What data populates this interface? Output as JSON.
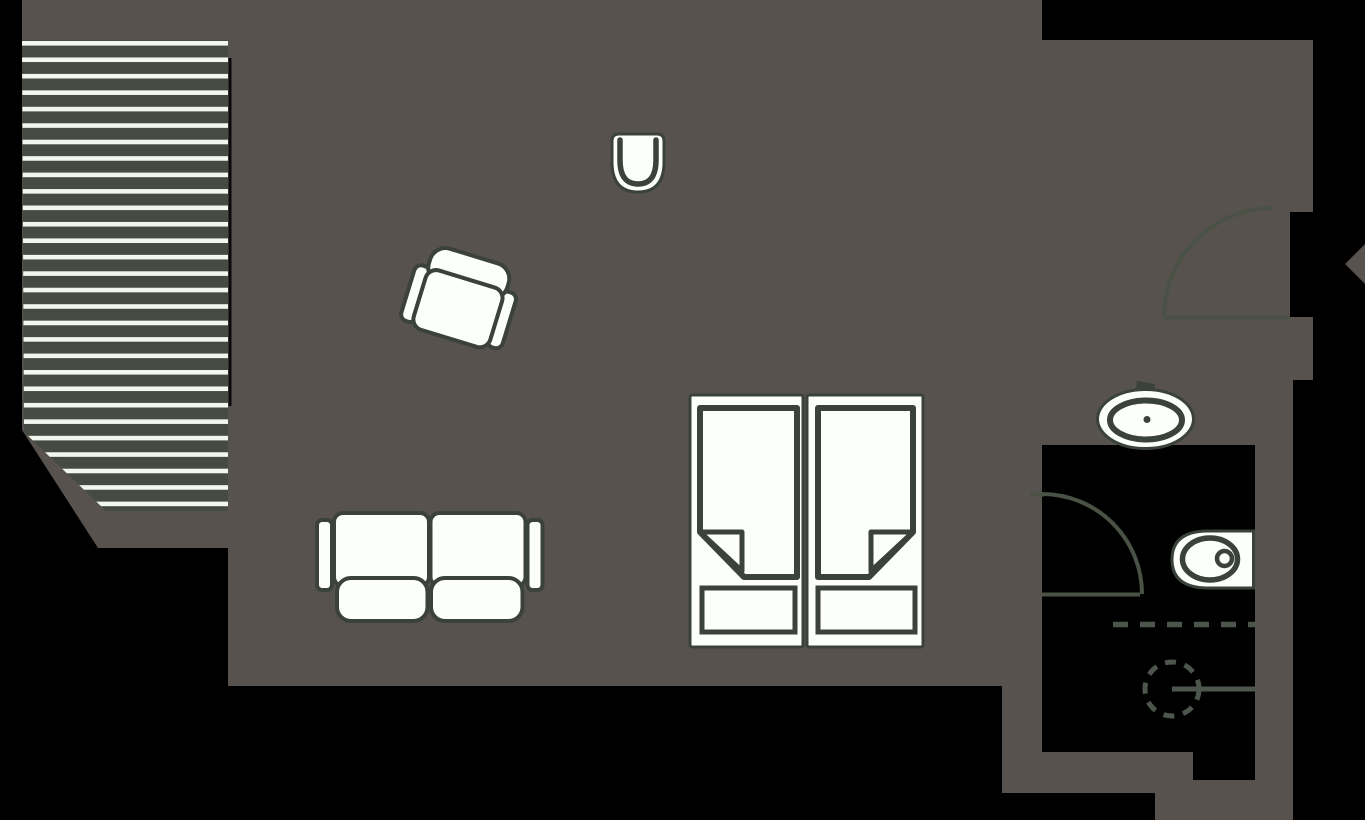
{
  "canvas": {
    "width": 1365,
    "height": 820
  },
  "palette": {
    "outside_black": "#000000",
    "floor_gray": "#57524e",
    "deck_green": "#454b41",
    "deck_stripe_white": "#f1f6ee",
    "furniture_white": "#fdfffc",
    "furniture_stroke": "#3a423b",
    "door_stroke": "#4a5245",
    "shower_stroke": "#4d564c",
    "wall_line_black": "#0a0a0a"
  },
  "layers": [
    {
      "name": "apartment-floor",
      "interactable": false,
      "shapes": [
        {
          "tag": "polygon",
          "attrs": {
            "points": "22,0 1042,0 1042,40 1313,40 1313,212 1290,212 1290,317 1313,317 1313,380 1293,380 1293,820 1155,820 1155,793 1002,793 1002,686 228,686 228,548 98,548 22,430",
            "fill": "@floor_gray"
          }
        }
      ]
    },
    {
      "name": "deck-terrace",
      "interactable": false,
      "shapes": [
        {
          "tag": "clipPath",
          "attrs": {
            "id": "deckClip"
          },
          "children": [
            {
              "tag": "polygon",
              "attrs": {
                "points": "22,40 228,40 228,511 106,511 24,432"
              }
            }
          ]
        },
        {
          "tag": "polygon",
          "attrs": {
            "points": "22,40 228,40 228,511 106,511 24,432",
            "fill": "@deck_green"
          }
        },
        {
          "tag": "g",
          "attrs": {
            "clip-path": "url(#deckClip)"
          },
          "children": [
            {
              "tag": "rect",
              "attrs": {
                "x": 22,
                "y": 41,
                "width": 206,
                "height": 4.6,
                "fill": "@deck_stripe_white"
              },
              "repeat": {
                "count": 29,
                "dy": 16.45
              }
            }
          ]
        }
      ]
    },
    {
      "name": "deck-wall-line",
      "interactable": false,
      "shapes": [
        {
          "tag": "rect",
          "attrs": {
            "x": 228.5,
            "y": 58,
            "width": 3,
            "height": 348,
            "fill": "@wall_line_black"
          }
        }
      ]
    },
    {
      "name": "bathroom-floor",
      "interactable": false,
      "shapes": [
        {
          "tag": "path",
          "attrs": {
            "d": "M 1042,445 H 1255 V 780 H 1193 V 752 H 1042 Z",
            "fill": "@outside_black"
          }
        }
      ]
    },
    {
      "name": "entry-door-swing",
      "interactable": false,
      "shapes": [
        {
          "tag": "line",
          "attrs": {
            "x1": 1164,
            "y1": 317.5,
            "x2": 1290,
            "y2": 317.5,
            "stroke": "@door_stroke",
            "stroke-width": 4
          }
        },
        {
          "tag": "path",
          "attrs": {
            "d": "M 1164,317 A 109 109 0 0 1 1273,208",
            "fill": "none",
            "stroke": "@door_stroke",
            "stroke-width": 4
          }
        }
      ]
    },
    {
      "name": "bathroom-door-swing",
      "interactable": false,
      "shapes": [
        {
          "tag": "line",
          "attrs": {
            "x1": 1030,
            "y1": 494.5,
            "x2": 1044,
            "y2": 494.5,
            "stroke": "@door_stroke",
            "stroke-width": 4
          }
        },
        {
          "tag": "path",
          "attrs": {
            "d": "M 1042,494 A 100 100 0 0 1 1142,594",
            "fill": "none",
            "stroke": "@door_stroke",
            "stroke-width": 4
          }
        },
        {
          "tag": "line",
          "attrs": {
            "x1": 1042,
            "y1": 594.5,
            "x2": 1140,
            "y2": 594.5,
            "stroke": "@door_stroke",
            "stroke-width": 4
          }
        }
      ]
    },
    {
      "name": "shower-area",
      "interactable": false,
      "shapes": [
        {
          "tag": "line",
          "attrs": {
            "x1": 1113,
            "y1": 624.5,
            "x2": 1255,
            "y2": 624.5,
            "stroke": "@shower_stroke",
            "stroke-width": 5.5,
            "stroke-dasharray": "15 12"
          }
        },
        {
          "tag": "circle",
          "attrs": {
            "cx": 1172,
            "cy": 689,
            "r": 27,
            "fill": "none",
            "stroke": "@shower_stroke",
            "stroke-width": 5,
            "stroke-dasharray": "11 9"
          }
        },
        {
          "tag": "line",
          "attrs": {
            "x1": 1172,
            "y1": 689,
            "x2": 1255,
            "y2": 689,
            "stroke": "@shower_stroke",
            "stroke-width": 5
          }
        }
      ]
    },
    {
      "name": "sink",
      "interactable": false,
      "shapes": [
        {
          "tag": "polygon",
          "attrs": {
            "points": "1137,381 1155,384 1154,391 1136,388",
            "fill": "@furniture_stroke"
          }
        },
        {
          "tag": "line",
          "attrs": {
            "x1": 1146.5,
            "y1": 386,
            "x2": 1146.5,
            "y2": 406,
            "stroke": "@furniture_stroke",
            "stroke-width": 5
          }
        },
        {
          "tag": "ellipse",
          "attrs": {
            "cx": 1145.5,
            "cy": 419,
            "rx": 48,
            "ry": 29.5,
            "fill": "@furniture_white",
            "stroke": "@furniture_stroke",
            "stroke-width": 3
          }
        },
        {
          "tag": "ellipse",
          "attrs": {
            "cx": 1146,
            "cy": 420,
            "rx": 36,
            "ry": 19.5,
            "fill": "none",
            "stroke": "@furniture_stroke",
            "stroke-width": 6
          }
        },
        {
          "tag": "circle",
          "attrs": {
            "cx": 1147,
            "cy": 419.5,
            "r": 3.5,
            "fill": "@furniture_stroke"
          }
        }
      ]
    },
    {
      "name": "toilet",
      "interactable": false,
      "shapes": [
        {
          "tag": "path",
          "attrs": {
            "d": "M 1253.5,531 L 1206,531 Q 1172,532 1172,559.5 Q 1172,587 1206,588 L 1253.5,588 Z",
            "fill": "@furniture_white",
            "stroke": "@furniture_stroke",
            "stroke-width": 3
          }
        },
        {
          "tag": "ellipse",
          "attrs": {
            "cx": 1210,
            "cy": 559,
            "rx": 27.5,
            "ry": 21,
            "fill": "none",
            "stroke": "@furniture_stroke",
            "stroke-width": 5.5
          }
        },
        {
          "tag": "circle",
          "attrs": {
            "cx": 1224.5,
            "cy": 558.5,
            "r": 7.5,
            "fill": "@furniture_white",
            "stroke": "@furniture_stroke",
            "stroke-width": 4.5
          }
        }
      ]
    },
    {
      "name": "double-bed",
      "interactable": false,
      "shapes": [
        {
          "tag": "rect",
          "attrs": {
            "x": 690,
            "y": 395,
            "width": 113,
            "height": 252,
            "rx": 2,
            "fill": "@furniture_white",
            "stroke": "@furniture_stroke",
            "stroke-width": 3
          }
        },
        {
          "tag": "rect",
          "attrs": {
            "x": 807,
            "y": 395,
            "width": 116,
            "height": 252,
            "rx": 2,
            "fill": "@furniture_white",
            "stroke": "@furniture_stroke",
            "stroke-width": 3
          }
        },
        {
          "tag": "path",
          "attrs": {
            "d": "M 700,408 L 797,408 L 797,577 L 744,577 L 700,532 Z",
            "fill": "@furniture_white",
            "stroke": "@furniture_stroke",
            "stroke-width": 6,
            "stroke-linejoin": "round"
          }
        },
        {
          "tag": "path",
          "attrs": {
            "d": "M 700,532 L 742,532 L 742,571 Z",
            "fill": "@furniture_white",
            "stroke": "@furniture_stroke",
            "stroke-width": 5,
            "stroke-linejoin": "round"
          }
        },
        {
          "tag": "rect",
          "attrs": {
            "x": 702,
            "y": 588,
            "width": 93,
            "height": 44,
            "fill": "@furniture_white",
            "stroke": "@furniture_stroke",
            "stroke-width": 5
          }
        },
        {
          "tag": "path",
          "attrs": {
            "d": "M 913,408 L 818,408 L 818,577 L 869,577 L 913,532 Z",
            "fill": "@furniture_white",
            "stroke": "@furniture_stroke",
            "stroke-width": 6,
            "stroke-linejoin": "round"
          }
        },
        {
          "tag": "path",
          "attrs": {
            "d": "M 913,532 L 871,532 L 871,571 Z",
            "fill": "@furniture_white",
            "stroke": "@furniture_stroke",
            "stroke-width": 5,
            "stroke-linejoin": "round"
          }
        },
        {
          "tag": "rect",
          "attrs": {
            "x": 818,
            "y": 588,
            "width": 97,
            "height": 44,
            "fill": "@furniture_white",
            "stroke": "@furniture_stroke",
            "stroke-width": 5
          }
        }
      ]
    },
    {
      "name": "sofa",
      "interactable": false,
      "shapes": [
        {
          "tag": "rect",
          "attrs": {
            "x": 317,
            "y": 520,
            "width": 15,
            "height": 70,
            "rx": 5,
            "fill": "@furniture_white",
            "stroke": "@furniture_stroke",
            "stroke-width": 4
          }
        },
        {
          "tag": "rect",
          "attrs": {
            "x": 527.5,
            "y": 520,
            "width": 15,
            "height": 70,
            "rx": 5,
            "fill": "@furniture_white",
            "stroke": "@furniture_stroke",
            "stroke-width": 4
          }
        },
        {
          "tag": "rect",
          "attrs": {
            "x": 334,
            "y": 513,
            "width": 95,
            "height": 73,
            "rx": 9,
            "fill": "@furniture_white",
            "stroke": "@furniture_stroke",
            "stroke-width": 4
          }
        },
        {
          "tag": "rect",
          "attrs": {
            "x": 430.5,
            "y": 513,
            "width": 95,
            "height": 73,
            "rx": 9,
            "fill": "@furniture_white",
            "stroke": "@furniture_stroke",
            "stroke-width": 4
          }
        },
        {
          "tag": "rect",
          "attrs": {
            "x": 337,
            "y": 578,
            "width": 90.5,
            "height": 43,
            "rx": 14,
            "fill": "@furniture_white",
            "stroke": "@furniture_stroke",
            "stroke-width": 4
          }
        },
        {
          "tag": "rect",
          "attrs": {
            "x": 431,
            "y": 578,
            "width": 91.5,
            "height": 43,
            "rx": 14,
            "fill": "@furniture_white",
            "stroke": "@furniture_stroke",
            "stroke-width": 4
          }
        }
      ]
    },
    {
      "name": "armchair",
      "interactable": false,
      "shapes": [
        {
          "tag": "g",
          "attrs": {
            "transform": "rotate(17 460 302)"
          },
          "children": [
            {
              "tag": "rect",
              "attrs": {
                "x": 407,
                "y": 278,
                "width": 16,
                "height": 58,
                "rx": 7,
                "fill": "@furniture_white",
                "stroke": "@furniture_stroke",
                "stroke-width": 4
              }
            },
            {
              "tag": "rect",
              "attrs": {
                "x": 497,
                "y": 278,
                "width": 16,
                "height": 58,
                "rx": 7,
                "fill": "@furniture_white",
                "stroke": "@furniture_stroke",
                "stroke-width": 4
              }
            },
            {
              "tag": "rect",
              "attrs": {
                "x": 419,
                "y": 254,
                "width": 82,
                "height": 36,
                "rx": 16,
                "fill": "@furniture_white",
                "stroke": "@furniture_stroke",
                "stroke-width": 4
              }
            },
            {
              "tag": "rect",
              "attrs": {
                "x": 420,
                "y": 278,
                "width": 80,
                "height": 62,
                "rx": 11,
                "fill": "@furniture_white",
                "stroke": "@furniture_stroke",
                "stroke-width": 4
              }
            }
          ]
        }
      ]
    },
    {
      "name": "tub-chair",
      "interactable": false,
      "shapes": [
        {
          "tag": "path",
          "attrs": {
            "d": "M 612,141 Q 612,134 619,134 L 657,134 Q 664,134 664,141 L 664,162 Q 664,192 638,192 Q 612,192 612,162 Z",
            "fill": "@furniture_white",
            "stroke": "@furniture_stroke",
            "stroke-width": 3
          }
        },
        {
          "tag": "path",
          "attrs": {
            "d": "M 620,140 L 620,160 Q 620,184 638,184 Q 656,184 656,160 L 656,140",
            "fill": "none",
            "stroke": "@furniture_stroke",
            "stroke-width": 5.5,
            "stroke-linecap": "round"
          }
        }
      ]
    },
    {
      "name": "pointer-diamond",
      "interactable": false,
      "shapes": [
        {
          "tag": "polygon",
          "attrs": {
            "points": "1345,264 1369,240 1393,264 1369,288",
            "fill": "@floor_gray"
          }
        }
      ]
    }
  ]
}
